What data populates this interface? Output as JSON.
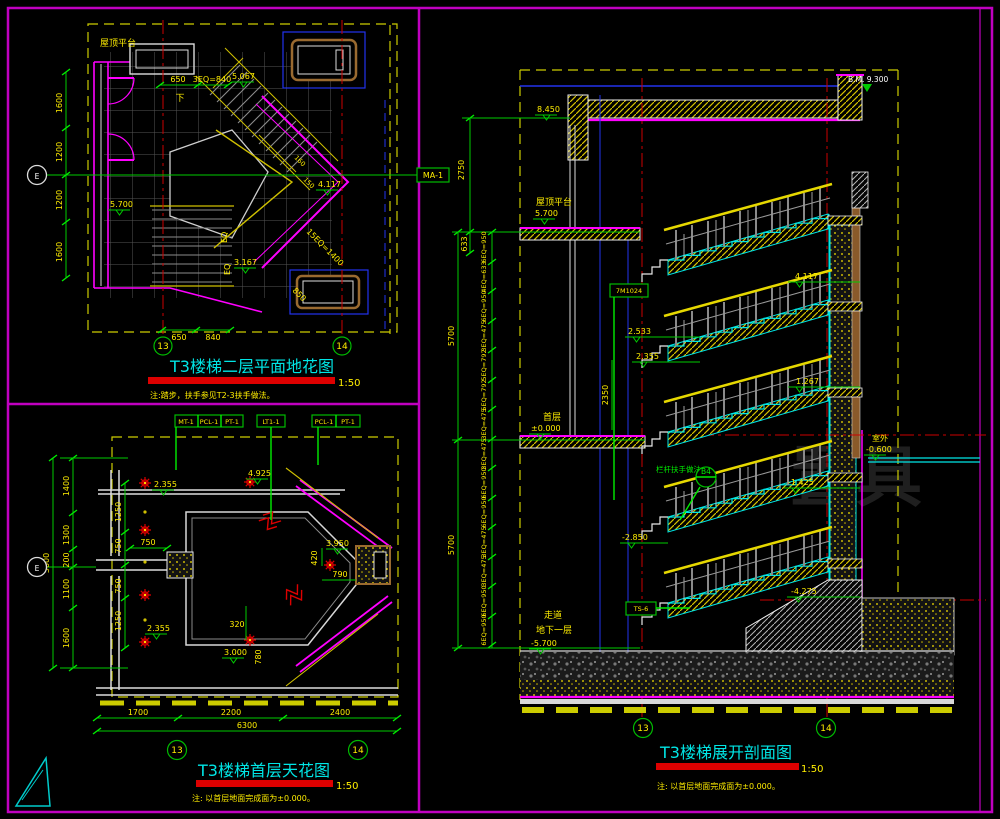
{
  "meta": {
    "bg": "#000000",
    "frame": "#c000c0",
    "green": "#00cc00",
    "yellow": "#ffee00",
    "cyan": "#00e5e5",
    "red": "#dd0000",
    "magenta": "#ff00ff"
  },
  "plan2f": {
    "title": "T3楼梯二层平面地花图",
    "scale": "1:50",
    "note": "注:踏步，扶手参见T2-3扶手做法。",
    "room": "屋顶平台",
    "down": "下",
    "tag": "MA-1",
    "bubble13": "13",
    "bubble14": "14",
    "axis": "E",
    "levels": {
      "a": "5.067",
      "b": "4.117",
      "c": "3.167",
      "d": "5.700"
    },
    "dims": {
      "top1": "650",
      "top2": "3EQ=840",
      "bot1": "650",
      "bot2": "840",
      "left": [
        "1600",
        "1200",
        "1200",
        "1600"
      ],
      "eq": "EQ",
      "diag1": "15EQ=1400",
      "diag2": "850",
      "diag3": "160",
      "diag4": "150"
    }
  },
  "ceiling1f": {
    "title": "T3楼梯首层天花图",
    "scale": "1:50",
    "note": "注: 以首层地面完成面为±0.000。",
    "tags": {
      "row1": [
        "MT-1",
        "PCL-1",
        "PT-1"
      ],
      "row2": "LT1-1",
      "row3": [
        "PCL-1",
        "PT-1"
      ]
    },
    "bubble13": "13",
    "bubble14": "14",
    "axis": "E",
    "levels": [
      "2.355",
      "4.925",
      "3.950",
      "2.355",
      "3.000"
    ],
    "dims": {
      "bottom": [
        "1700",
        "2200",
        "2400"
      ],
      "bottom_total": "6300",
      "left_outer": [
        "1400",
        "1300",
        "200",
        "1100",
        "1600"
      ],
      "left_total": "5600",
      "left_inner": [
        "1250",
        "750",
        "750",
        "1250"
      ],
      "d750": "750",
      "d320": "320",
      "d780": "780",
      "d420": "420",
      "d790": "790"
    }
  },
  "section": {
    "title": "T3楼梯展开剖面图",
    "scale": "1:50",
    "note": "注: 以首层地面完成面为±0.000。",
    "bm": "B.M. 9.300",
    "labels": {
      "roof": "屋顶平台",
      "first": "首层",
      "corridor": "走道",
      "basement": "地下一层",
      "outdoor": "室外"
    },
    "levels": {
      "l8450": "8.450",
      "l5700": "5.700",
      "l0": "±0.000",
      "lm5700": "-5.700",
      "lm0600": "-0.600",
      "l4117": "4.117",
      "l2533": "2.533",
      "l2355": "2.355",
      "l1267": "1.267",
      "lm1425": "-1.425",
      "lm2850": "-2.850",
      "lm4275": "-4.275"
    },
    "tags": {
      "t1": "7M1024",
      "t2": "TS-6",
      "detail": "栏杆扶手做法",
      "detail_ref": "B4"
    },
    "dims": {
      "d2750": "2750",
      "d633": "633",
      "d5700a": "5700",
      "d5700b": "5700",
      "d2350": "2350",
      "segments": [
        "6EQ=950",
        "4EQ=633",
        "6EQ=950",
        "3EQ=475",
        "5EQ=792",
        "5EQ=792",
        "3EQ=475",
        "3EQ=475",
        "6EQ=950",
        "6EQ=950",
        "3EQ=475",
        "3EQ=475",
        "6EQ=950",
        "6EQ=950"
      ]
    },
    "bubble13": "13",
    "bubble14": "14"
  },
  "watermark": "置具"
}
